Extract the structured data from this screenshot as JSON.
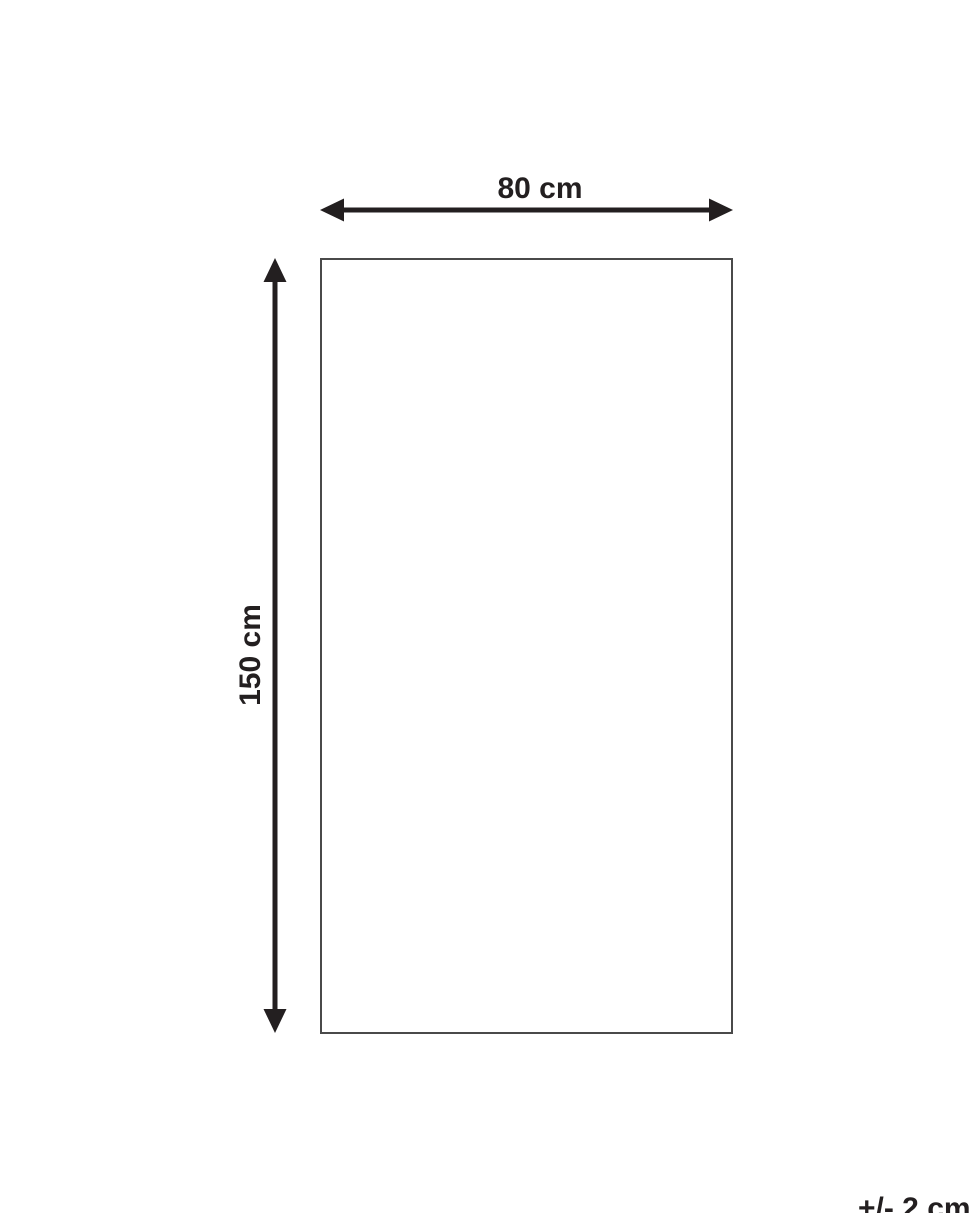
{
  "diagram": {
    "width_label": "80 cm",
    "height_label": "150 cm",
    "tolerance_label": "+/- 2 cm",
    "colors": {
      "arrow": "#231f20",
      "text": "#231f20",
      "outline": "#4a4a4a",
      "background": "#ffffff"
    }
  }
}
